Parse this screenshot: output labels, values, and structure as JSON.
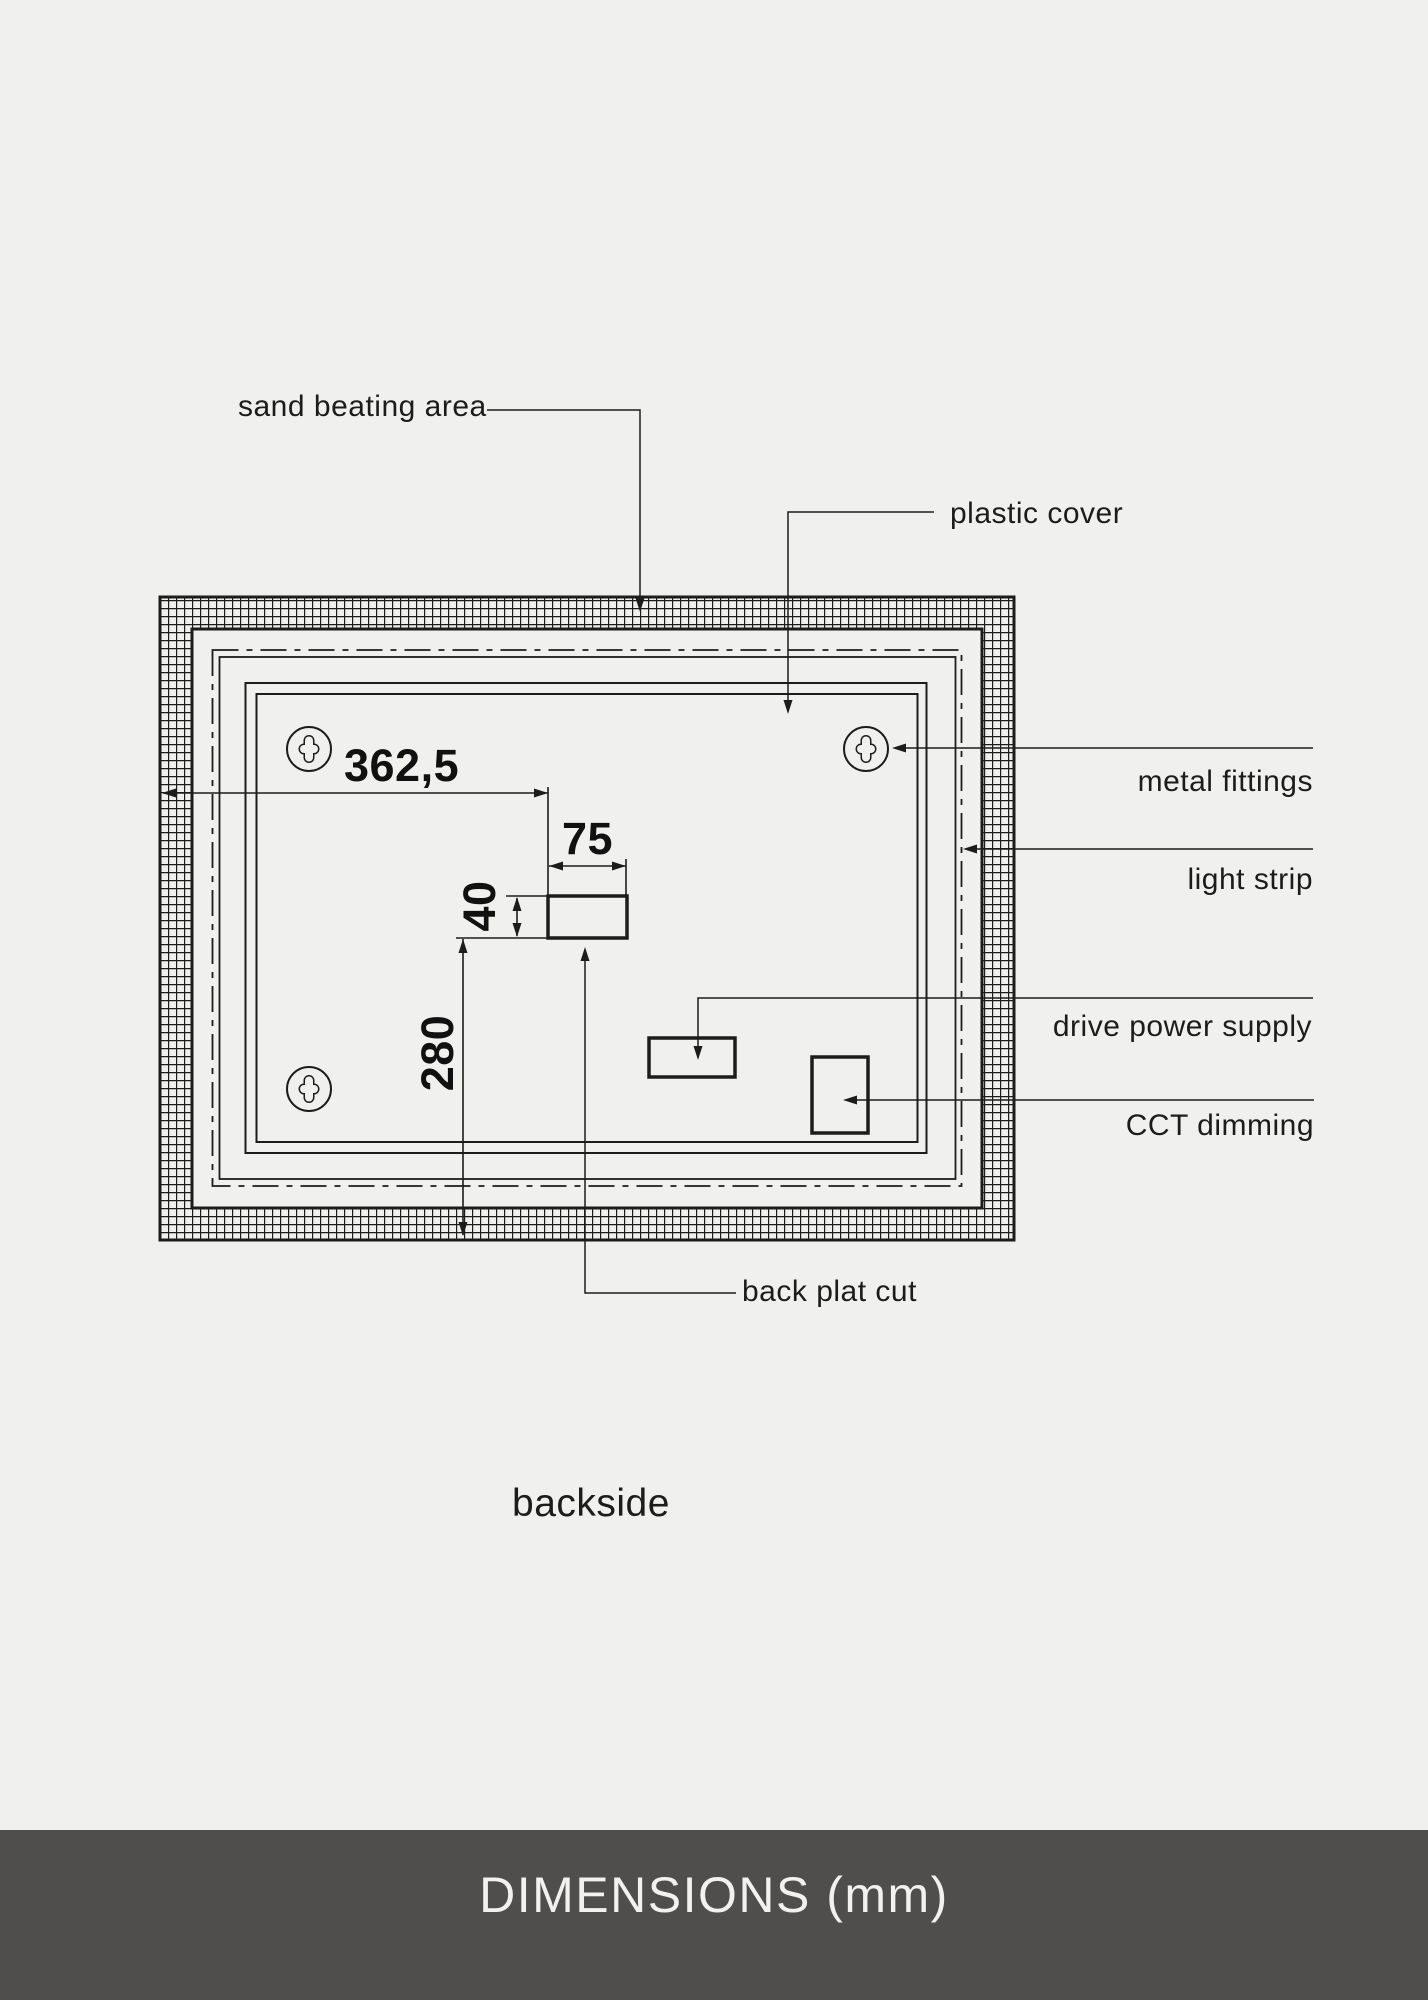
{
  "colors": {
    "background": "#f0f0ee",
    "line": "#1c1c1c",
    "footer_background": "#4f4e4c",
    "footer_text": "#f2f1ef"
  },
  "labels": {
    "sand_beating_area": "sand beating area",
    "plastic_cover": "plastic cover",
    "metal_fittings": "metal fittings",
    "light_strip": "light strip",
    "drive_power_supply": "drive power supply",
    "cct_dimming": "CCT dimming",
    "back_plat_cut": "back plat cut",
    "backside": "backside"
  },
  "dimensions": {
    "cut_offset_from_left": "362,5",
    "cut_width": "75",
    "cut_height": "40",
    "cut_offset_from_bottom": "280"
  },
  "footer": {
    "title": "DIMENSIONS (mm)"
  }
}
